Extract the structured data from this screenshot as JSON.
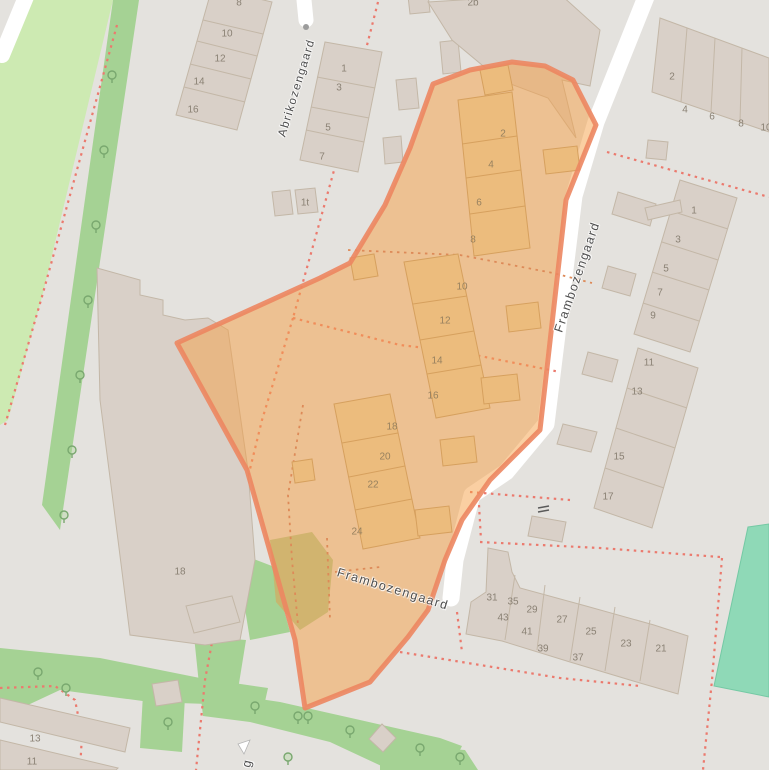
{
  "map_type": "openstreetmap-residential-map",
  "highlighted_area": {
    "name": "Frambozengaard block selection",
    "border_color": "#ec8660",
    "fill_color": "#f5a045"
  },
  "colors": {
    "background": "#e4e2de",
    "road": "#ffffff",
    "building": "#d9d0c8",
    "building_outline": "#c3b7a7",
    "building_in_selection": "#ecbc7d",
    "grass": "#cdeab2",
    "tree_strip": "#a5d294",
    "pitch": "#8fd9b7",
    "boundary_dashes": "#eb7a6e",
    "olive_patch": "#cbb269"
  },
  "street_labels": [
    {
      "text": "Abrikozengaard",
      "x": 297,
      "y": 88,
      "rot": -73,
      "size": 11.5
    },
    {
      "text": "Frambozengaard",
      "x": 577,
      "y": 277,
      "rot": -71,
      "size": 12.5
    },
    {
      "text": "Frambozengaard",
      "x": 393,
      "y": 589,
      "rot": 17,
      "size": 12.5
    },
    {
      "text": "g",
      "x": 247,
      "y": 763,
      "rot": -78,
      "size": 12.5
    }
  ],
  "house_numbers": [
    {
      "text": "8",
      "x": 239,
      "y": 3,
      "zone": "normal"
    },
    {
      "text": "10",
      "x": 227,
      "y": 34,
      "zone": "normal"
    },
    {
      "text": "12",
      "x": 220,
      "y": 59,
      "zone": "normal"
    },
    {
      "text": "14",
      "x": 199,
      "y": 82,
      "zone": "normal"
    },
    {
      "text": "16",
      "x": 193,
      "y": 110,
      "zone": "normal"
    },
    {
      "text": "1",
      "x": 344,
      "y": 69,
      "zone": "normal"
    },
    {
      "text": "3",
      "x": 339,
      "y": 88,
      "zone": "normal"
    },
    {
      "text": "5",
      "x": 328,
      "y": 128,
      "zone": "normal"
    },
    {
      "text": "7",
      "x": 322,
      "y": 157,
      "zone": "normal"
    },
    {
      "text": "1t",
      "x": 305,
      "y": 203,
      "zone": "normal"
    },
    {
      "text": "2b",
      "x": 473,
      "y": 3,
      "zone": "normal"
    },
    {
      "text": "2",
      "x": 672,
      "y": 77,
      "zone": "normal"
    },
    {
      "text": "4",
      "x": 685,
      "y": 110,
      "zone": "normal"
    },
    {
      "text": "6",
      "x": 712,
      "y": 117,
      "zone": "normal"
    },
    {
      "text": "8",
      "x": 741,
      "y": 124,
      "zone": "normal"
    },
    {
      "text": "10",
      "x": 766,
      "y": 128,
      "zone": "normal"
    },
    {
      "text": "1",
      "x": 694,
      "y": 211,
      "zone": "normal"
    },
    {
      "text": "3",
      "x": 678,
      "y": 240,
      "zone": "normal"
    },
    {
      "text": "5",
      "x": 666,
      "y": 269,
      "zone": "normal"
    },
    {
      "text": "7",
      "x": 660,
      "y": 293,
      "zone": "normal"
    },
    {
      "text": "9",
      "x": 653,
      "y": 316,
      "zone": "normal"
    },
    {
      "text": "11",
      "x": 649,
      "y": 363,
      "zone": "normal"
    },
    {
      "text": "13",
      "x": 637,
      "y": 392,
      "zone": "normal"
    },
    {
      "text": "15",
      "x": 619,
      "y": 457,
      "zone": "normal"
    },
    {
      "text": "17",
      "x": 608,
      "y": 497,
      "zone": "normal"
    },
    {
      "text": "13",
      "x": 35,
      "y": 739,
      "zone": "normal"
    },
    {
      "text": "11",
      "x": 32,
      "y": 762,
      "zone": "normal"
    },
    {
      "text": "18",
      "x": 180,
      "y": 572,
      "zone": "normal"
    },
    {
      "text": "31",
      "x": 492,
      "y": 598,
      "zone": "normal"
    },
    {
      "text": "35",
      "x": 513,
      "y": 602,
      "zone": "normal"
    },
    {
      "text": "43",
      "x": 503,
      "y": 618,
      "zone": "normal"
    },
    {
      "text": "29",
      "x": 532,
      "y": 610,
      "zone": "normal"
    },
    {
      "text": "41",
      "x": 527,
      "y": 632,
      "zone": "normal"
    },
    {
      "text": "39",
      "x": 543,
      "y": 649,
      "zone": "normal"
    },
    {
      "text": "27",
      "x": 562,
      "y": 620,
      "zone": "normal"
    },
    {
      "text": "25",
      "x": 591,
      "y": 632,
      "zone": "normal"
    },
    {
      "text": "37",
      "x": 578,
      "y": 658,
      "zone": "normal"
    },
    {
      "text": "23",
      "x": 626,
      "y": 644,
      "zone": "normal"
    },
    {
      "text": "21",
      "x": 661,
      "y": 649,
      "zone": "normal"
    },
    {
      "text": "2",
      "x": 503,
      "y": 134,
      "zone": "orange"
    },
    {
      "text": "4",
      "x": 491,
      "y": 165,
      "zone": "orange"
    },
    {
      "text": "6",
      "x": 479,
      "y": 203,
      "zone": "orange"
    },
    {
      "text": "8",
      "x": 473,
      "y": 240,
      "zone": "orange"
    },
    {
      "text": "10",
      "x": 462,
      "y": 287,
      "zone": "orange"
    },
    {
      "text": "12",
      "x": 445,
      "y": 321,
      "zone": "orange"
    },
    {
      "text": "14",
      "x": 437,
      "y": 361,
      "zone": "orange"
    },
    {
      "text": "16",
      "x": 433,
      "y": 396,
      "zone": "orange"
    },
    {
      "text": "18",
      "x": 392,
      "y": 427,
      "zone": "orange"
    },
    {
      "text": "20",
      "x": 385,
      "y": 457,
      "zone": "orange"
    },
    {
      "text": "22",
      "x": 373,
      "y": 485,
      "zone": "orange"
    },
    {
      "text": "24",
      "x": 357,
      "y": 532,
      "zone": "orange"
    }
  ]
}
